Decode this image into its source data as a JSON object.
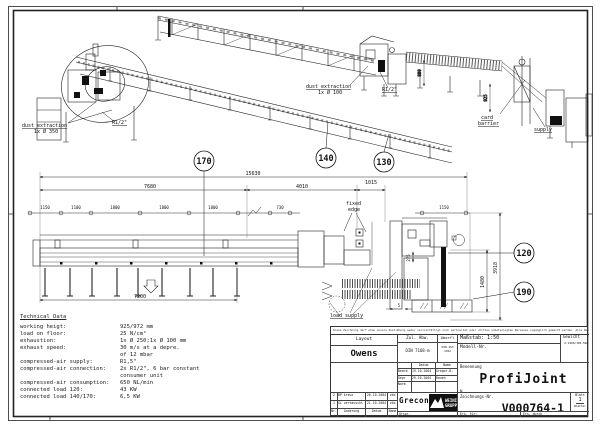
{
  "drawing": {
    "balloons": {
      "b170": "170",
      "b140": "140",
      "b130": "130",
      "b120": "120",
      "b190": "190"
    },
    "labels": {
      "dust_left_1": "dust extraction",
      "dust_left_2": "1x Ø 350",
      "r_half_left": "R1/2\"",
      "dust_mid_1": "dust extraction",
      "dust_mid_2": "1x Ø 100",
      "r_half_mid": "R1/2\"",
      "card_1": "card",
      "card_2": "barrier",
      "supply": "supply",
      "fixed_1": "fixed",
      "fixed_2": "edge",
      "load_supply": "load supply"
    },
    "dims": {
      "total": "15630",
      "seg1": "7680",
      "seg2": "4010",
      "seg3": "1015",
      "bottom": "7200",
      "right_inner": "1480",
      "right_outer": "3918",
      "depth": "275",
      "iso_a": "800",
      "iso_b": "925",
      "mid": "730",
      "right_top": "1150",
      "gap": "5",
      "chain": [
        "1150",
        "1100",
        "1800",
        "1800",
        "1800"
      ]
    }
  },
  "tech": {
    "title": "Technical Data",
    "rows": [
      {
        "l": "working heigt:",
        "v": "925/972 mm"
      },
      {
        "l": "load on floor:",
        "v": "25 N/cm²"
      },
      {
        "l": "exhaustion:",
        "v": "1x Ø 250;1x Ø 100 mm"
      },
      {
        "l": "exhaust speed:",
        "v": "30 m/s at a depre."
      },
      {
        "l": "",
        "v": "of 12 mbar"
      },
      {
        "l": "compressed-air supply:",
        "v": "R1,5\""
      },
      {
        "l": "compressed-air connection:",
        "v": "2x R1/2\", 6 bar constant"
      },
      {
        "l": "",
        "v": "consumer unit"
      },
      {
        "l": "compressed-air consumption:",
        "v": "650 NL/min"
      },
      {
        "l": "connected load 120:",
        "v": "43 KW"
      },
      {
        "l": "connected load 140/170:",
        "v": "6,5 KW"
      }
    ]
  },
  "titleblock": {
    "disclaimer": "Diese Zeichnung darf ohne unsere Zustimmung weder vervielfältigt noch verbreitet oder dritten unbeteiligten Personen zugänglich gemacht werden. Alle Rechte vorbehalten.",
    "layout_label": "Layout",
    "customer": "Owens",
    "zul_abw_label": "Zul. Abw.",
    "zul_abw_value": "DIN 7168-m",
    "oberfl_label": "Oberfl",
    "oberfl_value1": "DIN ISO",
    "oberfl_value2": "1302",
    "massstab": "Maßstab: 1:50",
    "gewicht_label": "Gewicht",
    "gewicht_value": "A:1906/185.52A",
    "modell_label": "Modell-Nr.",
    "datum_label": "Datum",
    "name_label": "Name",
    "bearb_label": "Bearb",
    "bearb_date": "19.10.2004",
    "bearb_name": "Gregor-B.",
    "gepr_label": "Gepr",
    "gepr_date": "29.10.2004",
    "gepr_name": "Rauen",
    "norm_label": "Norm",
    "benennung_label": "Benennung",
    "title": "ProfiJoint",
    "n_label": "N",
    "zeichnung_label": "Zeichnungs-Nr.",
    "zeichnung_nr": "V000764-1",
    "blatt_label": "Blatt",
    "blatt_value": "1",
    "blaetter_label": "Blätter",
    "ers_fuer": "Ers. für:",
    "ers_durch": "Ers. durch",
    "urspr_label": "Urspr.",
    "logo_text": "Grecon",
    "logo_group1": "WEINIG",
    "logo_group2": "GRUPPE",
    "revisions": [
      {
        "nr": "2",
        "text": "BP kreuz",
        "date": "26.10.2004",
        "name": "ckb"
      },
      {
        "nr": "1",
        "text": "SL vertauscht",
        "date": "21.10.2004",
        "name": "ckb"
      }
    ],
    "rev_nr": "Nr.",
    "rev_aenderung": "Änderung",
    "rev_datum": "Datum",
    "rev_name": "Name"
  }
}
